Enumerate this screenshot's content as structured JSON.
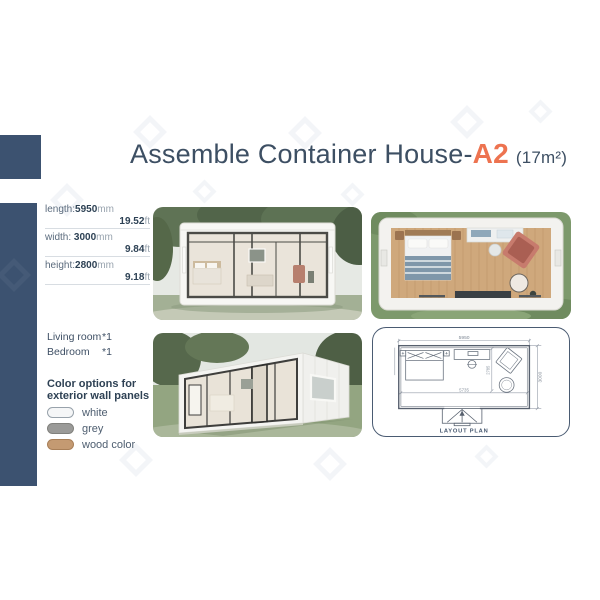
{
  "title": {
    "main": "Assemble Container House-",
    "model": "A2",
    "area": "(17m²)"
  },
  "specs": [
    {
      "label": "length:",
      "metric": "5950",
      "metric_unit": "mm",
      "imperial": "19.52",
      "imperial_unit": "ft"
    },
    {
      "label": "width: ",
      "metric": "3000",
      "metric_unit": "mm",
      "imperial": "9.84",
      "imperial_unit": "ft"
    },
    {
      "label": "height:",
      "metric": "2800",
      "metric_unit": "mm",
      "imperial": "9.18",
      "imperial_unit": "ft"
    }
  ],
  "rooms": [
    {
      "name": "Living room",
      "count": "*1"
    },
    {
      "name": "Bedroom",
      "count": "*1"
    }
  ],
  "color_options": {
    "heading_line1": "Color options for",
    "heading_line2": "exterior wall panels",
    "swatches": [
      {
        "label": "white",
        "color": "#f5f6f7",
        "border": "#98a2ab"
      },
      {
        "label": "grey",
        "color": "#9a9a98",
        "border": "#81817d"
      },
      {
        "label": "wood color",
        "color": "#c49a72",
        "border": "#a87f58"
      }
    ]
  },
  "plan": {
    "caption": "LAYOUT PLAN",
    "dimensions": {
      "exterior_length": "5950",
      "exterior_width": "3000",
      "interior_length": "5735",
      "interior_width": "2785"
    }
  },
  "colors": {
    "accent_orange": "#ed7350",
    "navy": "#3c5270",
    "title_text": "#3d4f63"
  }
}
